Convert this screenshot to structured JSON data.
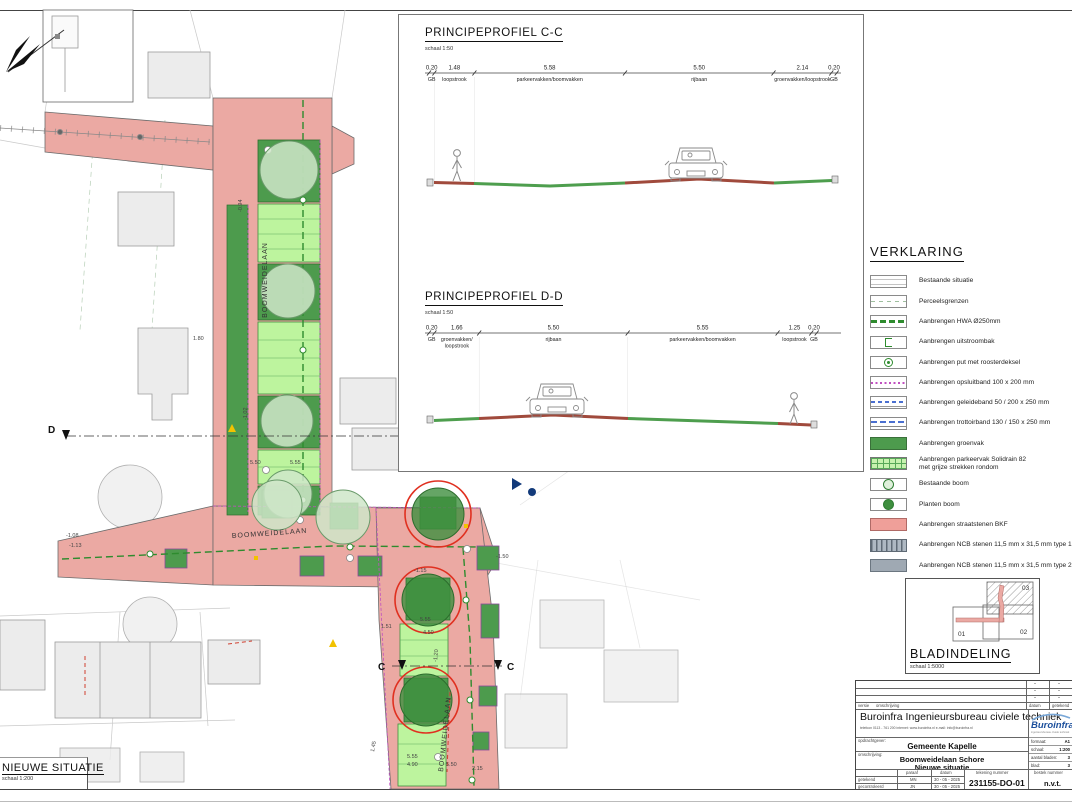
{
  "plan": {
    "title": "NIEUWE SITUATIE",
    "scale": "schaal 1:200",
    "streets": {
      "top": "BOOMWEIDELAAN",
      "mid": "BOOMWEIDELAAN",
      "bottom": "BOOMWEIDELAAN"
    },
    "sections": {
      "c": "C",
      "d": "D"
    },
    "dims": [
      "1.80",
      "5.50",
      "5.55",
      "1.51",
      "5.55",
      "4.50",
      "1.45",
      "5.55",
      "4.90",
      "5.50",
      "2.15",
      "-1.08",
      "-1.13",
      "-1.02",
      "-0.94",
      "-1.50",
      "-1.15",
      "-1.20"
    ]
  },
  "profiles": {
    "cc": {
      "title": "PRINCIPEPROFIEL C-C",
      "scale": "schaal 1:50",
      "segments": [
        {
          "w": "0.20",
          "label": "GB"
        },
        {
          "w": "1.48",
          "label": "loopstrook"
        },
        {
          "w": "5.58",
          "label": "parkeervakken/boomvakken"
        },
        {
          "w": "5.50",
          "label": "rijbaan"
        },
        {
          "w": "2.14",
          "label": "groenvakken/loopstrook"
        },
        {
          "w": "0.20",
          "label": "GB"
        }
      ]
    },
    "dd": {
      "title": "PRINCIPEPROFIEL D-D",
      "scale": "schaal 1:50",
      "segments": [
        {
          "w": "0.20",
          "label": "GB"
        },
        {
          "w": "1.66",
          "label": "groenvakken/",
          "label2": "loopstrook"
        },
        {
          "w": "5.50",
          "label": "rijbaan"
        },
        {
          "w": "5.55",
          "label": "parkeervakken/boomvakken"
        },
        {
          "w": "1.25",
          "label": "loopstrook"
        },
        {
          "w": "0.20",
          "label": "GB"
        }
      ]
    }
  },
  "legend": {
    "title": "VERKLARING",
    "items": [
      {
        "label": "Bestaande situatie"
      },
      {
        "label": "Perceelsgrenzen"
      },
      {
        "label": "Aanbrengen HWA Ø250mm"
      },
      {
        "label": "Aanbrengen uitstroombak"
      },
      {
        "label": "Aanbrengen put met roosterdeksel"
      },
      {
        "label": "Aanbrengen opsluitband 100 x 200 mm"
      },
      {
        "label": "Aanbrengen geleideband 50 / 200 x 250 mm"
      },
      {
        "label": "Aanbrengen trottoirband 130 / 150 x 250 mm"
      },
      {
        "label": "Aanbrengen groenvak"
      },
      {
        "label": "Aanbrengen parkeervak Solidrain 82\nmet grijze strekken rondom"
      },
      {
        "label": "Bestaande boom"
      },
      {
        "label": "Planten boom"
      },
      {
        "label": "Aanbrengen straatstenen BKF"
      },
      {
        "label": "Aanbrengen NCB stenen 11,5 mm x 31,5 mm type 1"
      },
      {
        "label": "Aanbrengen NCB stenen 11,5 mm x 31,5 mm type 2"
      }
    ]
  },
  "bladindeling": {
    "title": "BLADINDELING",
    "scale": "schaal 1:5000",
    "sheets": [
      "01",
      "02",
      "03"
    ]
  },
  "titleblock": {
    "company": "Buroinfra Ingenieursbureau civiele techniek",
    "company_sub": "telefoon 0113 - 761 200    internet: www.buroinfra.nl    e-mail: info@buroinfra.nl",
    "opdrachtgever_label": "opdrachtgever:",
    "opdrachtgever": "Gemeente Kapelle",
    "omschrijving_label": "omschrijving:",
    "project": "Boomweidelaan Schore",
    "subtitle": "Nieuwe situatie",
    "col_paraaf": "paraaf",
    "col_datum": "datum",
    "col_tekening": "tekening nummer",
    "col_bestek": "bestek nummer",
    "getekend": "getekend",
    "getekend_paraaf": "MN",
    "getekend_datum": "30 - 05 - 2025",
    "gecontroleerd": "gecontroleerd",
    "gecontroleerd_paraaf": "JN",
    "gecontroleerd_datum": "30 - 05 - 2025",
    "tekeningnummer": "231155-DO-01",
    "bestek": "n.v.t.",
    "logo": "Buroinfra",
    "logo_sub": "ingenieursbureau civiele techniek",
    "formaat_label": "formaat:",
    "formaat": "A1",
    "schaal_label": "schaal:",
    "schaal": "1:200",
    "bladen_label": "aantal bladen:",
    "bladen": "3",
    "blad_label": "blad:",
    "blad": "3",
    "versie": "versie",
    "omschrijving_col": "omschrijving",
    "rev_datum": "datum",
    "rev_getekend": "getekend",
    "dash": "-"
  },
  "colors": {
    "road": "#EBA9A3",
    "parking": "#BDF49E",
    "green": "#4D9B4D",
    "hwa": "#2E8B2E",
    "band": "#C050C0",
    "tree_ring": "#E03020",
    "logo_blue": "#1B4F9C",
    "ncb1": "#AEB8C2",
    "ncb2": "#9FA9B3"
  }
}
